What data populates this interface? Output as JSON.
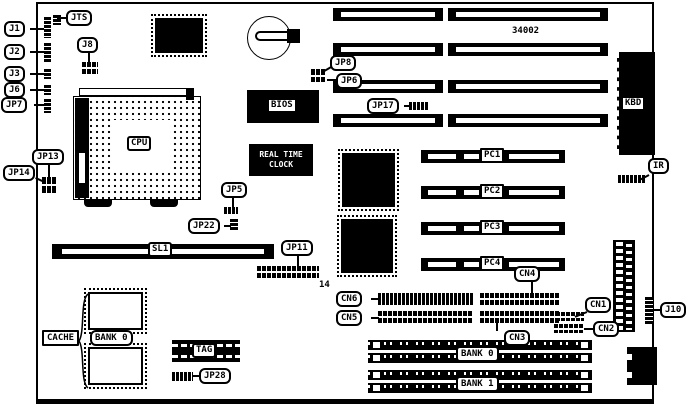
{
  "board": {
    "part_number": "34002"
  },
  "chips": {
    "cpu": "CPU",
    "bios": "BIOS",
    "rtc_line1": "REAL TIME",
    "rtc_line2": "CLOCK",
    "tag": "TAG",
    "kbd": "KBD"
  },
  "slots": {
    "sl1": "SL1",
    "pci": [
      "PC1",
      "PC2",
      "PC3",
      "PC4"
    ],
    "simm_banks": [
      "BANK 0",
      "BANK 1"
    ]
  },
  "cache": {
    "label": "CACHE",
    "bank": "BANK 0"
  },
  "jumpers": {
    "jts": "JTS",
    "j1": "J1",
    "j2": "J2",
    "j3": "J3",
    "j6": "J6",
    "jp7": "JP7",
    "j8": "J8",
    "jp8": "JP8",
    "jp6": "JP6",
    "jp17": "JP17",
    "jp13": "JP13",
    "jp14": "JP14",
    "jp5": "JP5",
    "jp22": "JP22",
    "jp11": "JP11",
    "jp11_pin_count": "14",
    "jp28": "JP28",
    "j10": "J10",
    "ir": "IR"
  },
  "connectors": {
    "cn1": "CN1",
    "cn2": "CN2",
    "cn3": "CN3",
    "cn4": "CN4",
    "cn5": "CN5",
    "cn6": "CN6"
  }
}
